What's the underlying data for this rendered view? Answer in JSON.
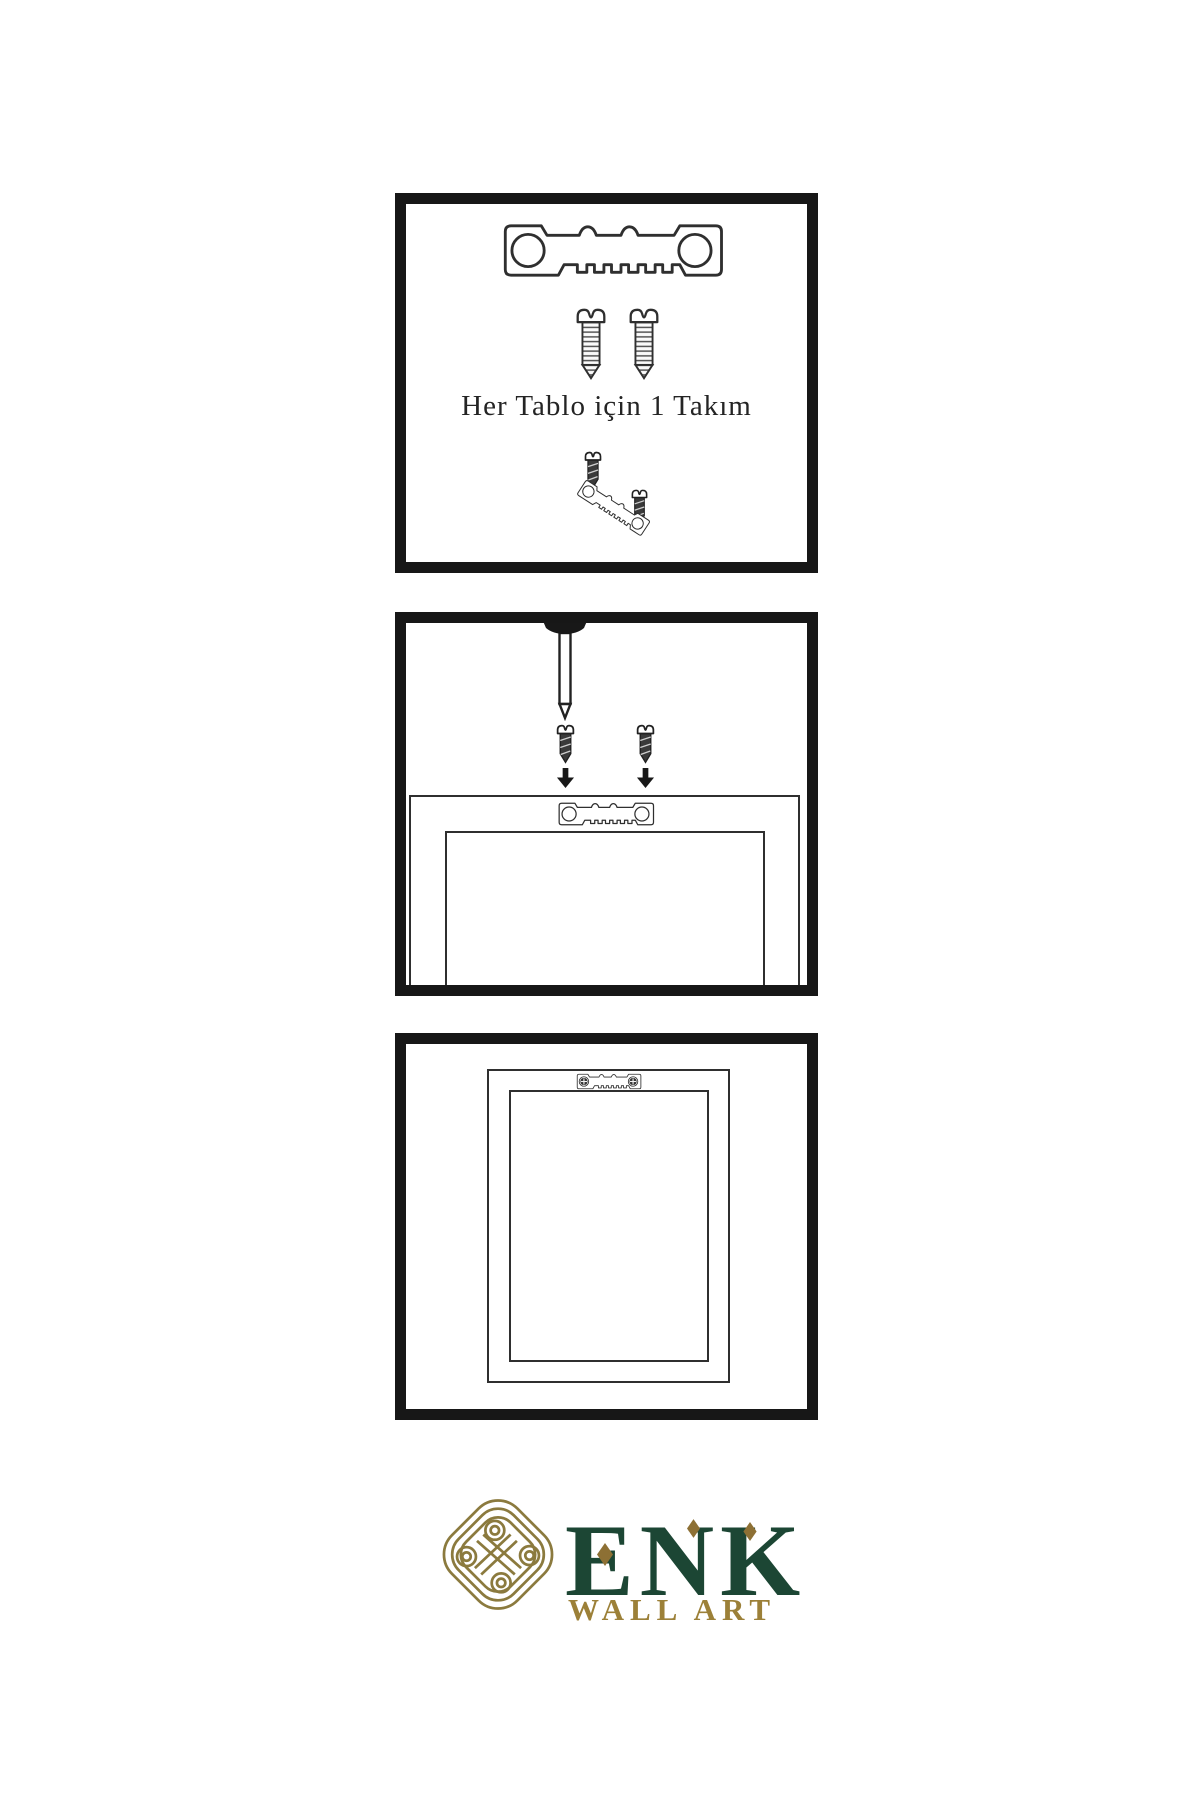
{
  "page": {
    "background_color": "#ffffff",
    "kind": "wall-art hanging hardware instruction sheet"
  },
  "colors": {
    "panel_border": "#171717",
    "line_art": "#2f2f2f",
    "dark_hardware_fill": "#3a3a3a",
    "logo_green": "#1c4634",
    "logo_gold": "#8b7a3e",
    "logo_gold_text": "#9c8038",
    "logo_diamond": "#8d7034"
  },
  "instruction": {
    "set_caption": "Her Tablo için 1 Takım"
  },
  "steps": [
    {
      "name": "hardware set",
      "caption": "Her Tablo için 1 Takım",
      "icons": [
        "sawtooth-hanger-icon",
        "screw-icon",
        "screw-icon",
        "screw-into-hanger-icon"
      ]
    },
    {
      "name": "attach hanger to frame back under wall nail",
      "icons": [
        "nail-icon",
        "screw-icon",
        "down-arrow-icon",
        "sawtooth-hanger-icon",
        "frame-back-icon"
      ]
    },
    {
      "name": "hanger mounted on frame back",
      "icons": [
        "frame-back-icon",
        "mounted-sawtooth-hanger-icon"
      ]
    }
  ],
  "logo": {
    "brand": "ENK",
    "subtitle": "WALL ART",
    "mark": "knot-icon"
  }
}
